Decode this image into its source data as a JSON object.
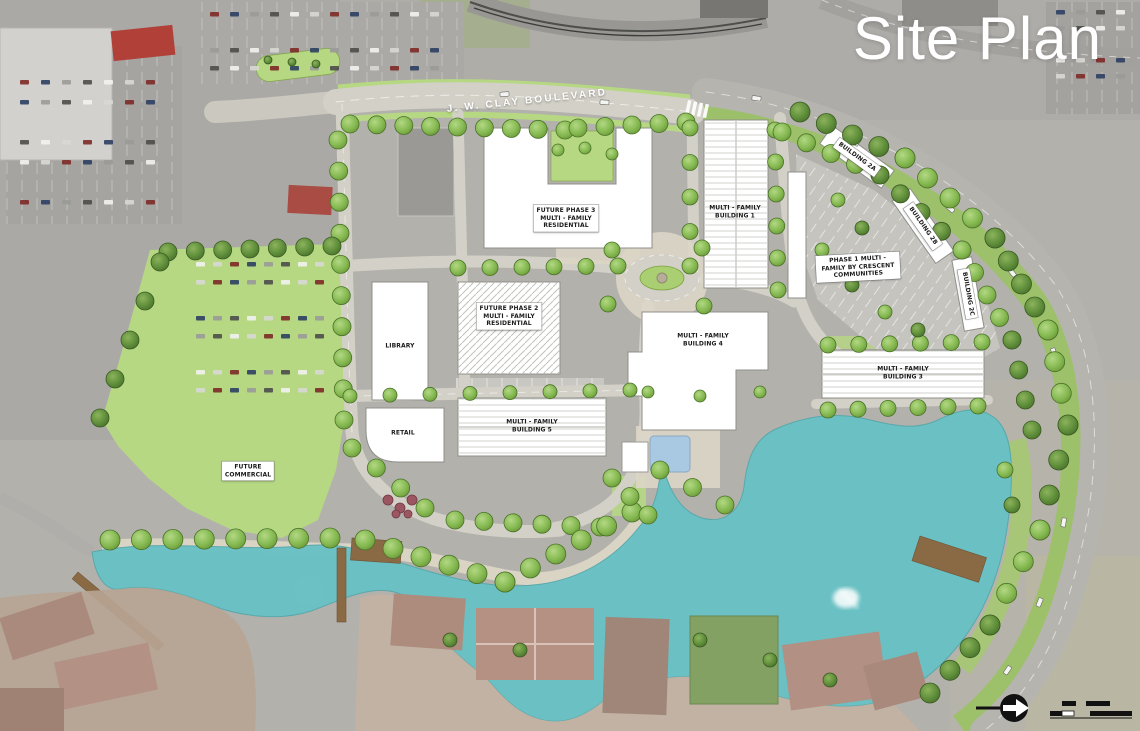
{
  "title": "Site Plan",
  "roads": {
    "jw_clay": "J. W. CLAY BOULEVARD"
  },
  "labels": {
    "future_phase_3": "FUTURE PHASE 3\nMULTI - FAMILY\nRESIDENTIAL",
    "mf_building_1": "MULTI - FAMILY\nBUILDING 1",
    "building_2a": "BUILDING 2A",
    "building_2b": "BUILDING 2B",
    "building_2c": "BUILDING 2C",
    "phase_1_crescent": "PHASE 1 MULTI -\nFAMILY BY CRESCENT\nCOMMUNITIES",
    "future_phase_2": "FUTURE PHASE 2\nMULTI - FAMILY\nRESIDENTIAL",
    "library": "LIBRARY",
    "retail": "RETAIL",
    "mf_building_5": "MULTI - FAMILY\nBUILDING 5",
    "mf_building_4": "MULTI - FAMILY\nBUILDING 4",
    "mf_building_3": "MULTI - FAMILY\nBUILDING 3",
    "future_commercial": "FUTURE\nCOMMERCIAL"
  },
  "icons": {
    "north_arrow": "north-arrow",
    "scale_bar": "graphic-scale"
  },
  "colors": {
    "title": "#ffffff",
    "lake": "#68c1c4",
    "lawn": "#b6d883",
    "tree": "#85b951",
    "tree_dark": "#5f8e3a",
    "road": "#d3d0c7",
    "plaza": "#dcd6c6",
    "building": "#ffffff",
    "aerial": "#b3b1ac",
    "pool": "#a9c9e2",
    "roof": "#b08a7c",
    "boardwalk": "#8a6a45"
  }
}
